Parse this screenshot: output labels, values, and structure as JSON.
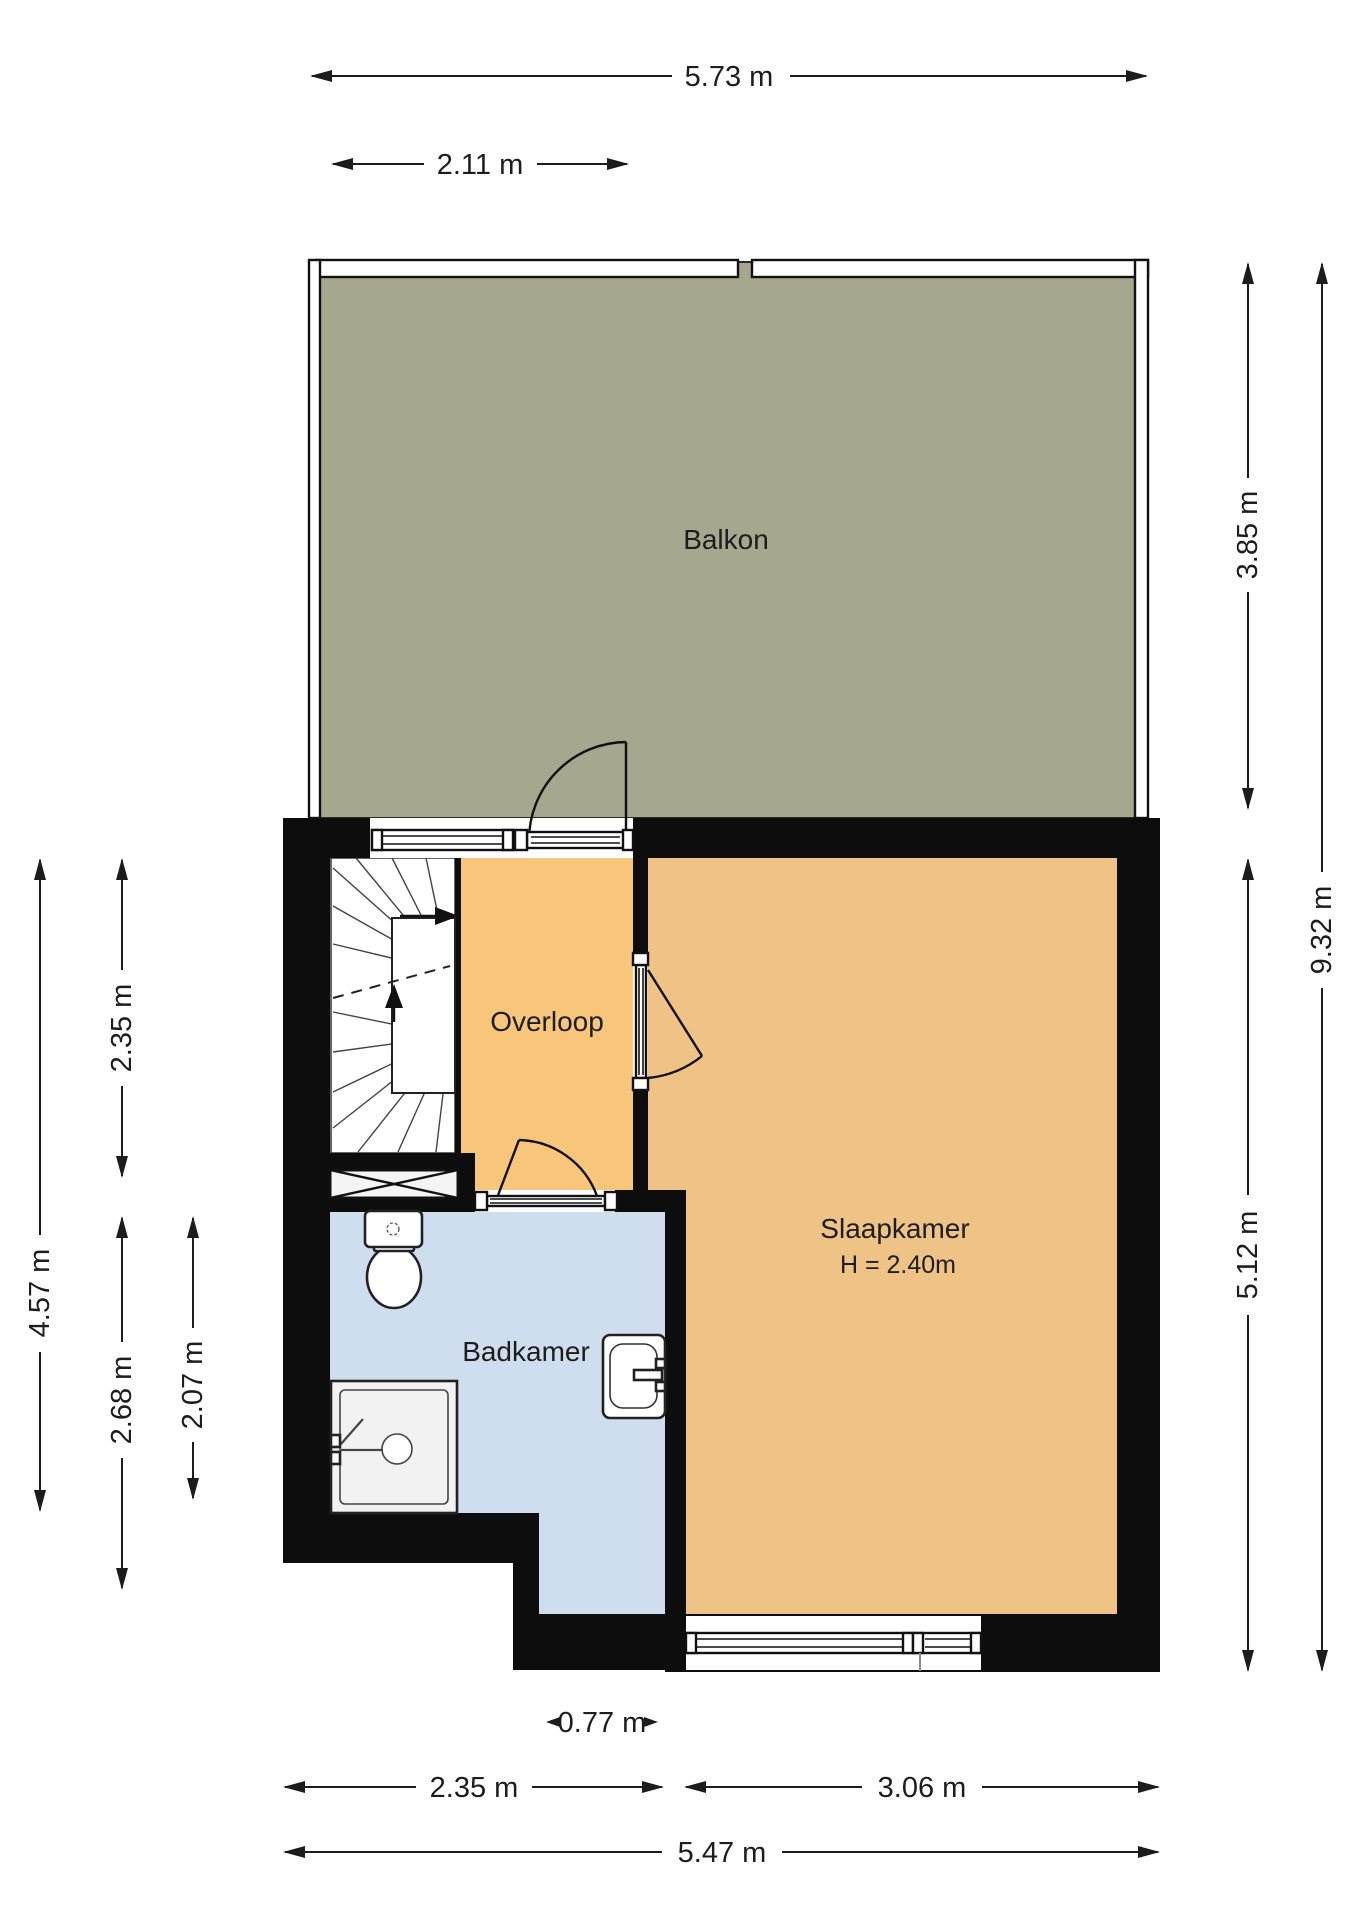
{
  "plan": {
    "rooms": {
      "balcony": {
        "label": "Balkon"
      },
      "landing": {
        "label": "Overloop"
      },
      "bedroom": {
        "label": "Slaapkamer",
        "ceiling_height": "H = 2.40m"
      },
      "bathroom": {
        "label": "Badkamer"
      }
    },
    "dimensions": {
      "top_total": "5.73 m",
      "top_left_section": "2.11 m",
      "left_total": "4.57 m",
      "left_stairwell": "2.35 m",
      "left_bathroom_outer": "2.68 m",
      "left_bathroom_inner": "2.07 m",
      "right_balcony": "3.85 m",
      "right_total": "9.32 m",
      "right_bedroom": "5.12 m",
      "bottom_notch": "0.77 m",
      "bottom_bathroom": "2.35 m",
      "bottom_bedroom": "3.06 m",
      "bottom_total": "5.47 m"
    },
    "colors": {
      "balcony_fill": "#a5a78f",
      "landing_fill": "#f7c67a",
      "bedroom_fill": "#efc385",
      "bathroom_fill": "#cfdeee",
      "shower_fill": "#f2f2f2",
      "wall": "#0d0d0d",
      "dimension_text": "#1d1d1d"
    }
  }
}
